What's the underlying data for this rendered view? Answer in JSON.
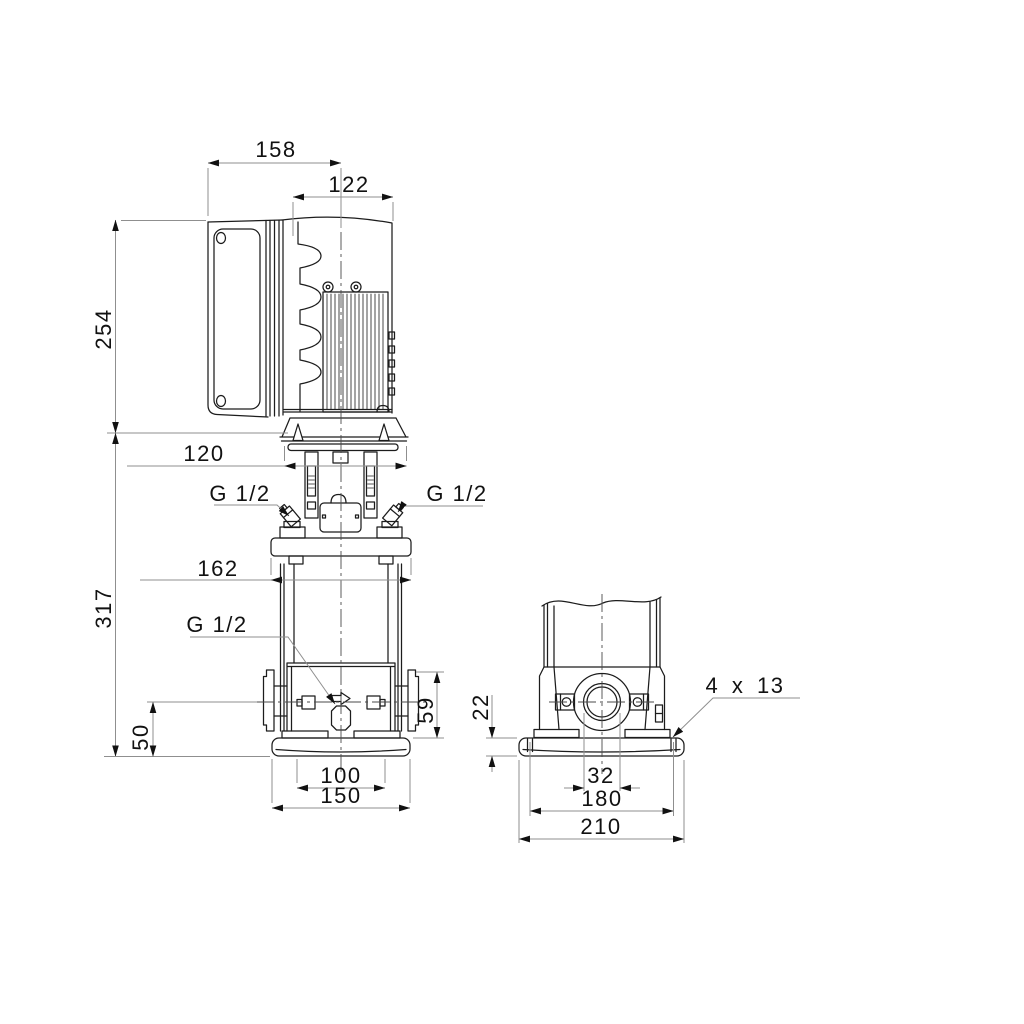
{
  "dimensions": {
    "side_view": {
      "overall_depth": "158",
      "motor_diameter": "122",
      "motor_height": "254",
      "motor_flange_diameter": "120",
      "pump_height": "317",
      "pump_head_width": "162",
      "port_centerline_height": "50",
      "port_flange_height": "59",
      "base_slot_spacing": "100",
      "base_width": "150",
      "priming_plug_left": "G 1/2",
      "priming_plug_right": "G 1/2",
      "drain_plug": "G 1/2"
    },
    "end_view": {
      "base_plate_height": "22",
      "port_width": "32",
      "bolt_hole_spacing": "180",
      "base_length": "210",
      "bolt_holes": "4 x 13"
    }
  }
}
